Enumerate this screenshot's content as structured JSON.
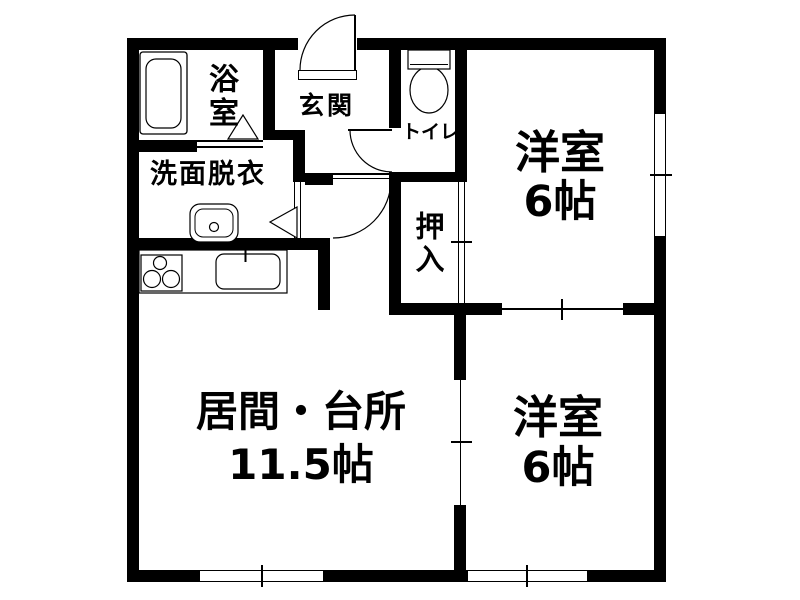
{
  "plan": {
    "type": "apartment-floor-plan",
    "colors": {
      "wall": "#000000",
      "background": "#ffffff",
      "line": "#000000",
      "text": "#000000"
    },
    "rooms": {
      "bathroom": {
        "label": "浴室"
      },
      "washroom": {
        "label": "洗面脱衣"
      },
      "entrance": {
        "label": "玄関"
      },
      "toilet": {
        "label": "トイレ"
      },
      "closet": {
        "label": "押入"
      },
      "bedroom_top": {
        "label": "洋室",
        "size": "6帖"
      },
      "bedroom_bottom": {
        "label": "洋室",
        "size": "6帖"
      },
      "living_kitchen": {
        "label": "居間・台所",
        "size": "11.5帖"
      }
    },
    "fixtures": [
      "bathtub-icon",
      "washbasin-icon",
      "toilet-icon",
      "stove-icon",
      "kitchen-sink-icon"
    ],
    "symbols": [
      "hinged-door-arc",
      "folding-door-triangle",
      "sliding-door-line",
      "window-frame"
    ]
  }
}
